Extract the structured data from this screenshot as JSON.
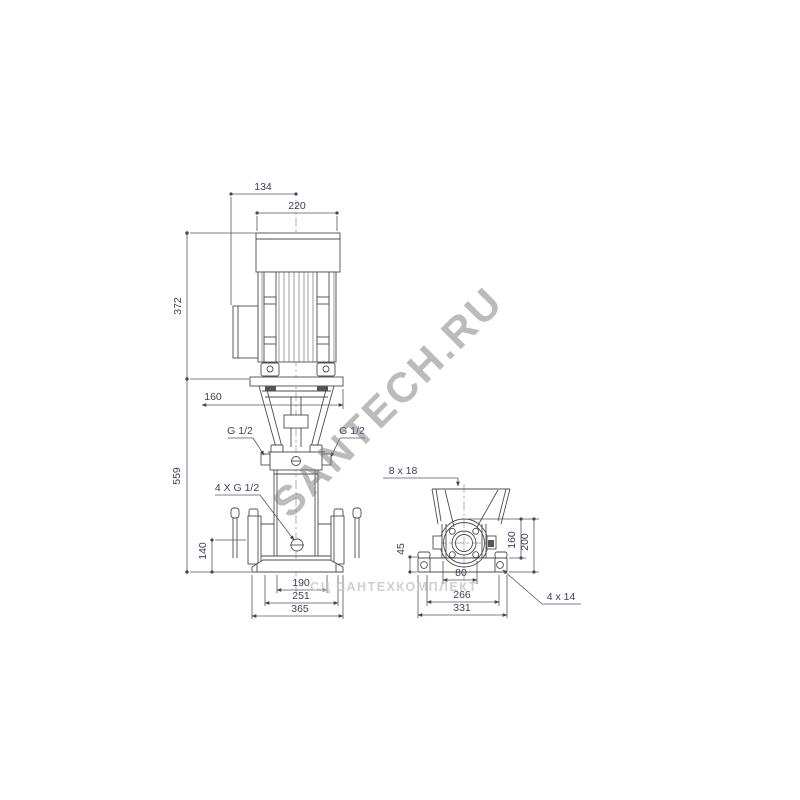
{
  "front": {
    "dim_134": "134",
    "dim_220": "220",
    "dim_372": "372",
    "dim_559": "559",
    "dim_160": "160",
    "dim_140": "140",
    "dim_190": "190",
    "dim_251": "251",
    "dim_365": "365",
    "label_g12_left": "G 1/2",
    "label_g12_right": "G 1/2",
    "label_4xg12": "4 X G 1/2"
  },
  "side": {
    "label_8x18": "8 x 18",
    "dim_45": "45",
    "dim_160": "160",
    "dim_200": "200",
    "dim_80": "80",
    "dim_266": "266",
    "dim_331": "331",
    "label_4x14": "4 x 14"
  },
  "watermark": {
    "primary": "SANTECH.RU",
    "secondary": "СЦ САНТЕХКОМПЛЕКТ"
  }
}
